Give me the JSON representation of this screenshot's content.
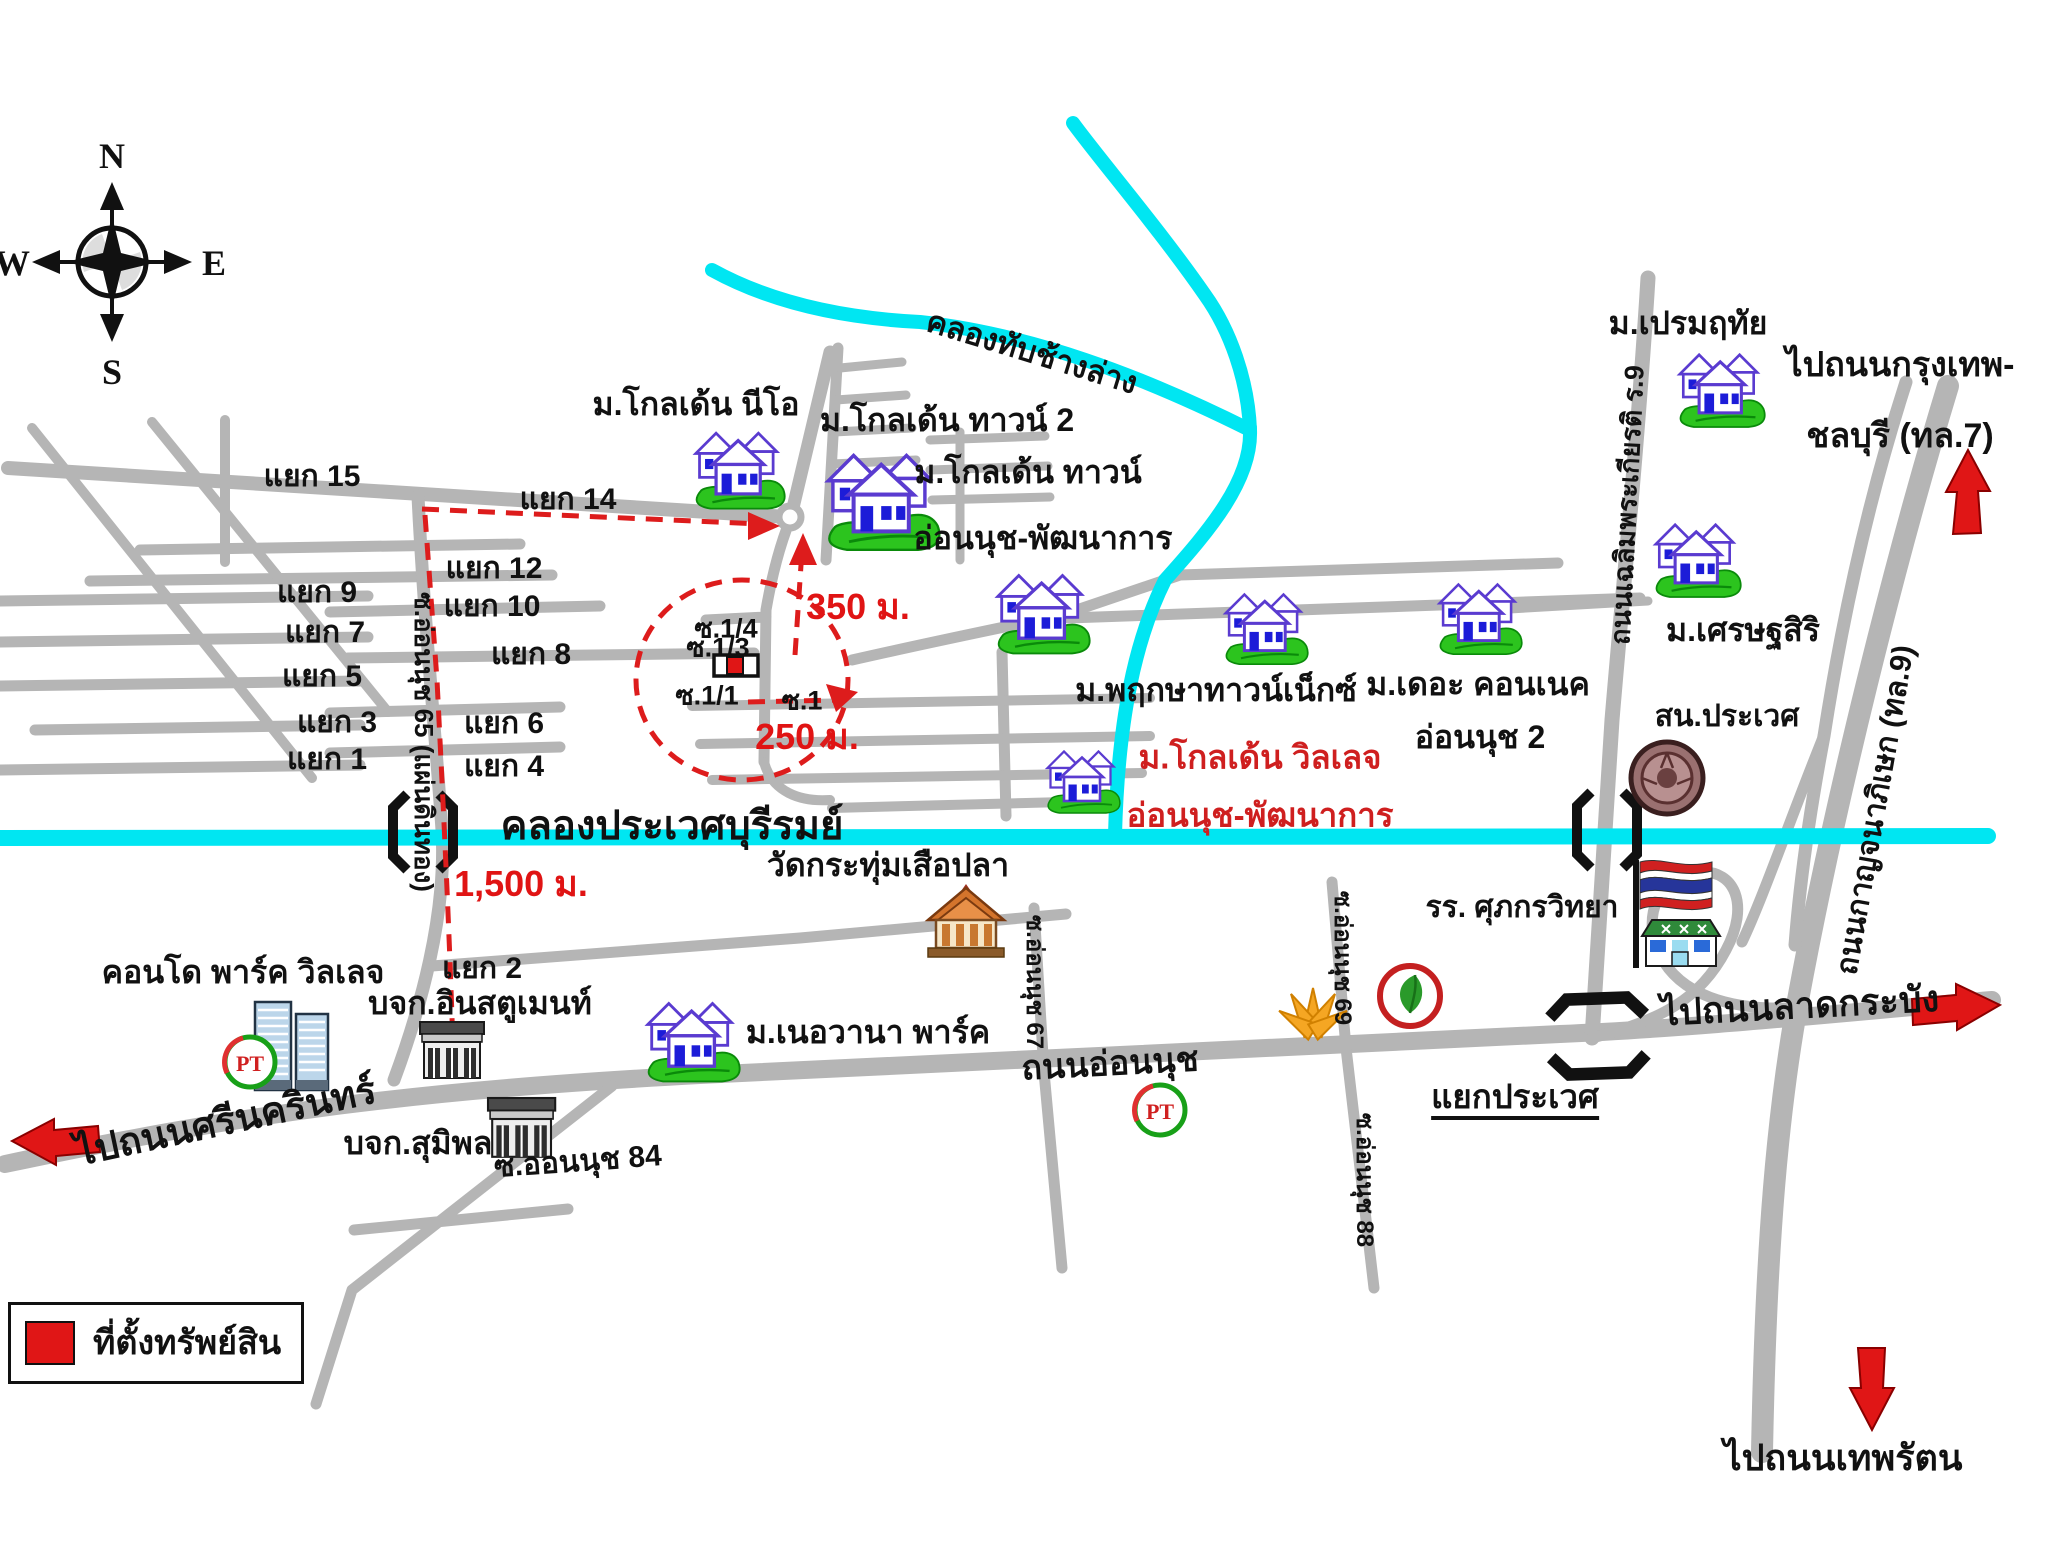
{
  "compass": {
    "n": "N",
    "e": "E",
    "s": "S",
    "w": "W"
  },
  "legend": {
    "property_label": "ที่ตั้งทรัพย์สิน"
  },
  "canals": {
    "tap_chang": "คลองทับช้างล่าง",
    "prawet_buri_rom": "คลองประเวศบุรีรมย์"
  },
  "roads": {
    "onnut": "ถนนอ่อนนุช",
    "soi65": "ซ.อ่อนนุช 65 (แผ่นดินทอง)",
    "soi67": "ซ.อ่อนนุช 67",
    "soi69": "ซ.อ่อนนุช 69",
    "soi88": "ซ.อ่อนนุช 88",
    "soi84": "ซ.ออนนุช 84",
    "chalermprakiat": "ถนนเฉลิมพระเกียรติ ร.9",
    "kanchanaphisek": "ถนนกาญจนาภิเษก (ทล.9)"
  },
  "directions": {
    "to_srinakarin": "ไปถนนศรีนครินทร์",
    "to_ladkrabang": "ไปถนนลาดกระบัง",
    "to_theppharat": "ไปถนนเทพรัตน",
    "to_bangkok_chonburi_line1": "ไปถนนกรุงเทพ-",
    "to_bangkok_chonburi_line2": "ชลบุรี (ทล.7)"
  },
  "junctions": {
    "y1": "แยก 1",
    "y2": "แยก 2",
    "y3": "แยก 3",
    "y4": "แยก 4",
    "y5": "แยก 5",
    "y6": "แยก 6",
    "y7": "แยก 7",
    "y8": "แยก 8",
    "y9": "แยก 9",
    "y10": "แยก 10",
    "y12": "แยก 12",
    "y14": "แยก 14",
    "y15": "แยก 15",
    "prawet": "แยกประเวศ"
  },
  "property_sois": {
    "s1": "ซ.1",
    "s1_1": "ซ.1/1",
    "s1_3": "ซ.1/3",
    "s1_4": "ซ.1/4"
  },
  "distances": {
    "d350": "350 ม.",
    "d250": "250 ม.",
    "d1500": "1,500 ม."
  },
  "places": {
    "golden_neo": "ม.โกลเด้น นีโอ",
    "golden_town2": "ม.โกลเด้น ทาวน์ 2",
    "golden_town_onnut_line1": "ม.โกลเด้น ทาวน์",
    "golden_town_onnut_line2": "อ่อนนุช-พัฒนาการ",
    "pruksa": "ม.พฤกษาทาวน์เน็กซ์",
    "connect_line1": "ม.เดอะ คอนเนค",
    "connect_line2": "อ่อนนุช 2",
    "golden_village_line1": "ม.โกลเด้น วิลเลจ",
    "golden_village_line2": "อ่อนนุช-พัฒนาการ",
    "prem_ruethai": "ม.เปรมฤทัย",
    "setthasiri": "ม.เศรษฐสิริ",
    "police": "สน.ประเวศ",
    "school": "รร. ศุภกรวิทยา",
    "wat": "วัดกระทุ่มเสือปลา",
    "nirvana": "ม.เนอวานา พาร์ค",
    "condo": "คอนโด พาร์ค วิลเลจ",
    "instrument": "บจก.อินสตูเมนท์",
    "sumipol": "บจก.สุมิพล"
  },
  "icons": {
    "pt_text": "PT"
  },
  "colors": {
    "road": "#b5b5b5",
    "canal": "#00e6f2",
    "route_red": "#dd1c1c",
    "label_red": "#cf1f1f"
  }
}
